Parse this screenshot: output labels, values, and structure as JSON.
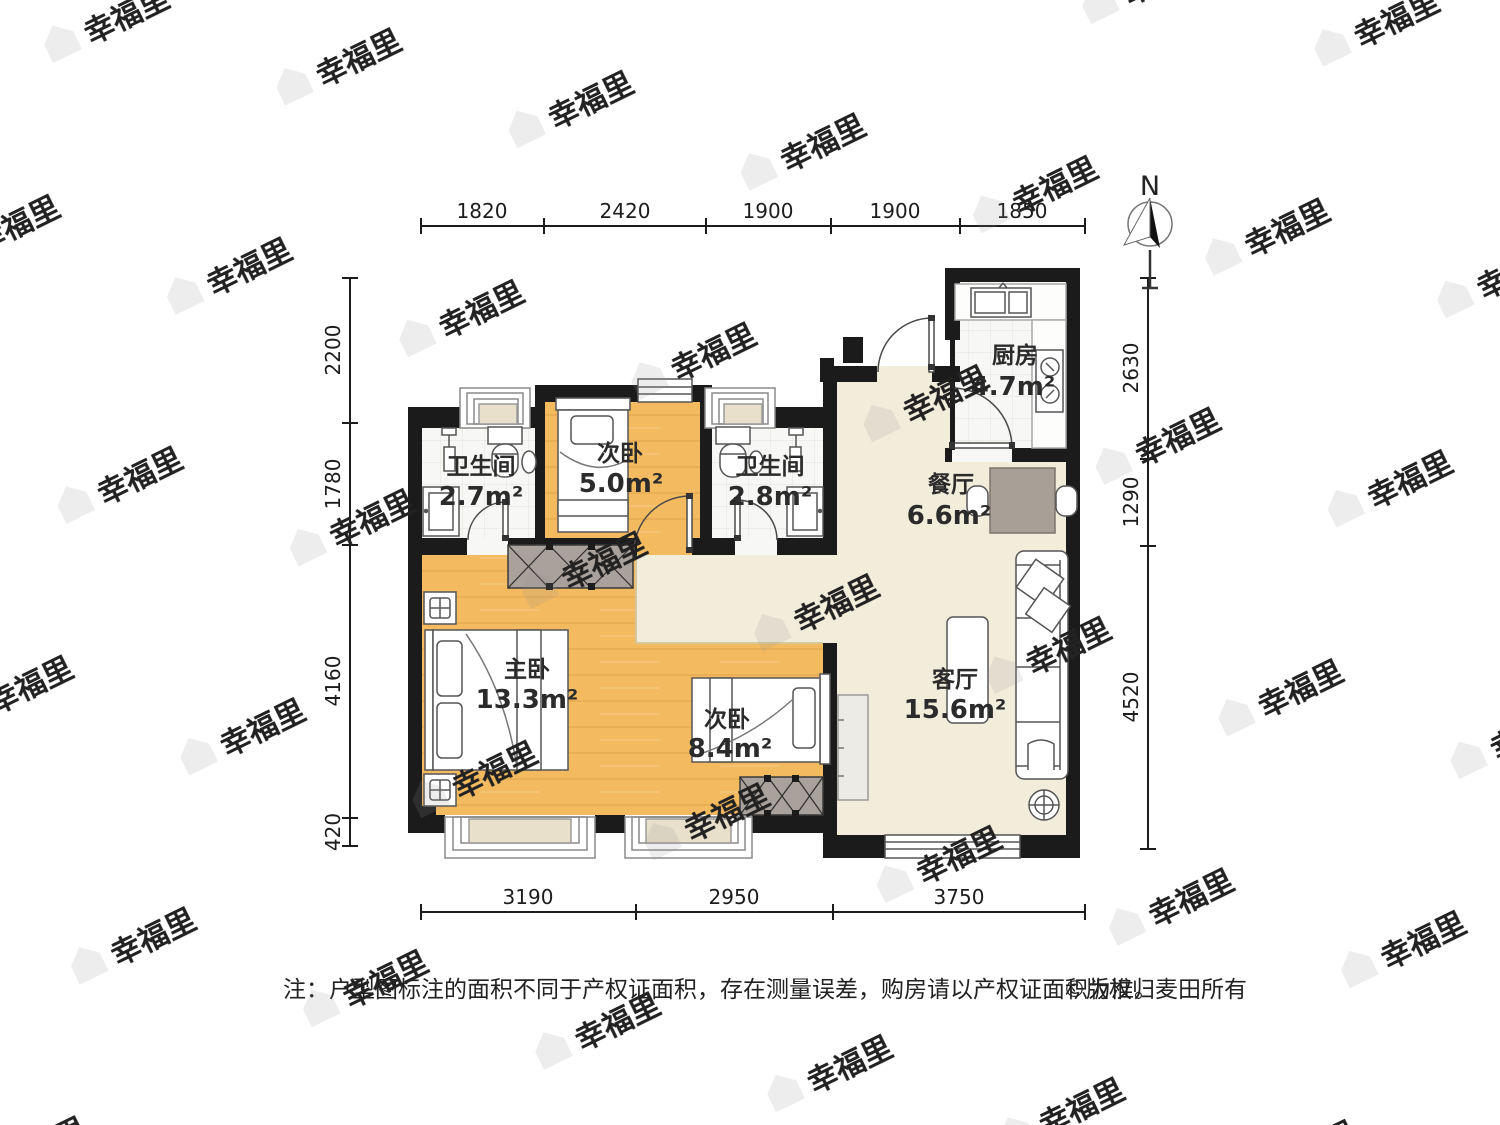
{
  "compass": {
    "label": "N"
  },
  "dimensions": {
    "top": [
      "1820",
      "2420",
      "1900",
      "1900",
      "1850"
    ],
    "left": [
      "2200",
      "1780",
      "4160",
      "420"
    ],
    "right": [
      "2630",
      "1290",
      "4520"
    ],
    "bottom": [
      "3190",
      "2950",
      "3750"
    ]
  },
  "rooms": {
    "bath1": {
      "name": "卫生间",
      "area": "2.7m²"
    },
    "bedroom2": {
      "name": "次卧",
      "area": "5.0m²"
    },
    "bath2": {
      "name": "卫生间",
      "area": "2.8m²"
    },
    "kitchen": {
      "name": "厨房",
      "area": "4.7m²"
    },
    "dining": {
      "name": "餐厅",
      "area": "6.6m²"
    },
    "master": {
      "name": "主卧",
      "area": "13.3m²"
    },
    "bedroom3": {
      "name": "次卧",
      "area": "8.4m²"
    },
    "living": {
      "name": "客厅",
      "area": "15.6m²"
    }
  },
  "note": {
    "text": "注：户型图标注的面积不同于产权证面积，存在测量误差，购房请以产权证面积为准。",
    "copyright": "©版权归麦田所有"
  },
  "watermark": {
    "text": "幸福里"
  },
  "colors": {
    "wall": "#1b1b1b",
    "wood_floor": "#f3ba60",
    "living_floor": "#f2ecda",
    "tile_floor": "#f7f7f5",
    "wardrobe": "#a9a19b",
    "dining_table": "#a89f96",
    "window_sill": "#e9e0cb"
  }
}
